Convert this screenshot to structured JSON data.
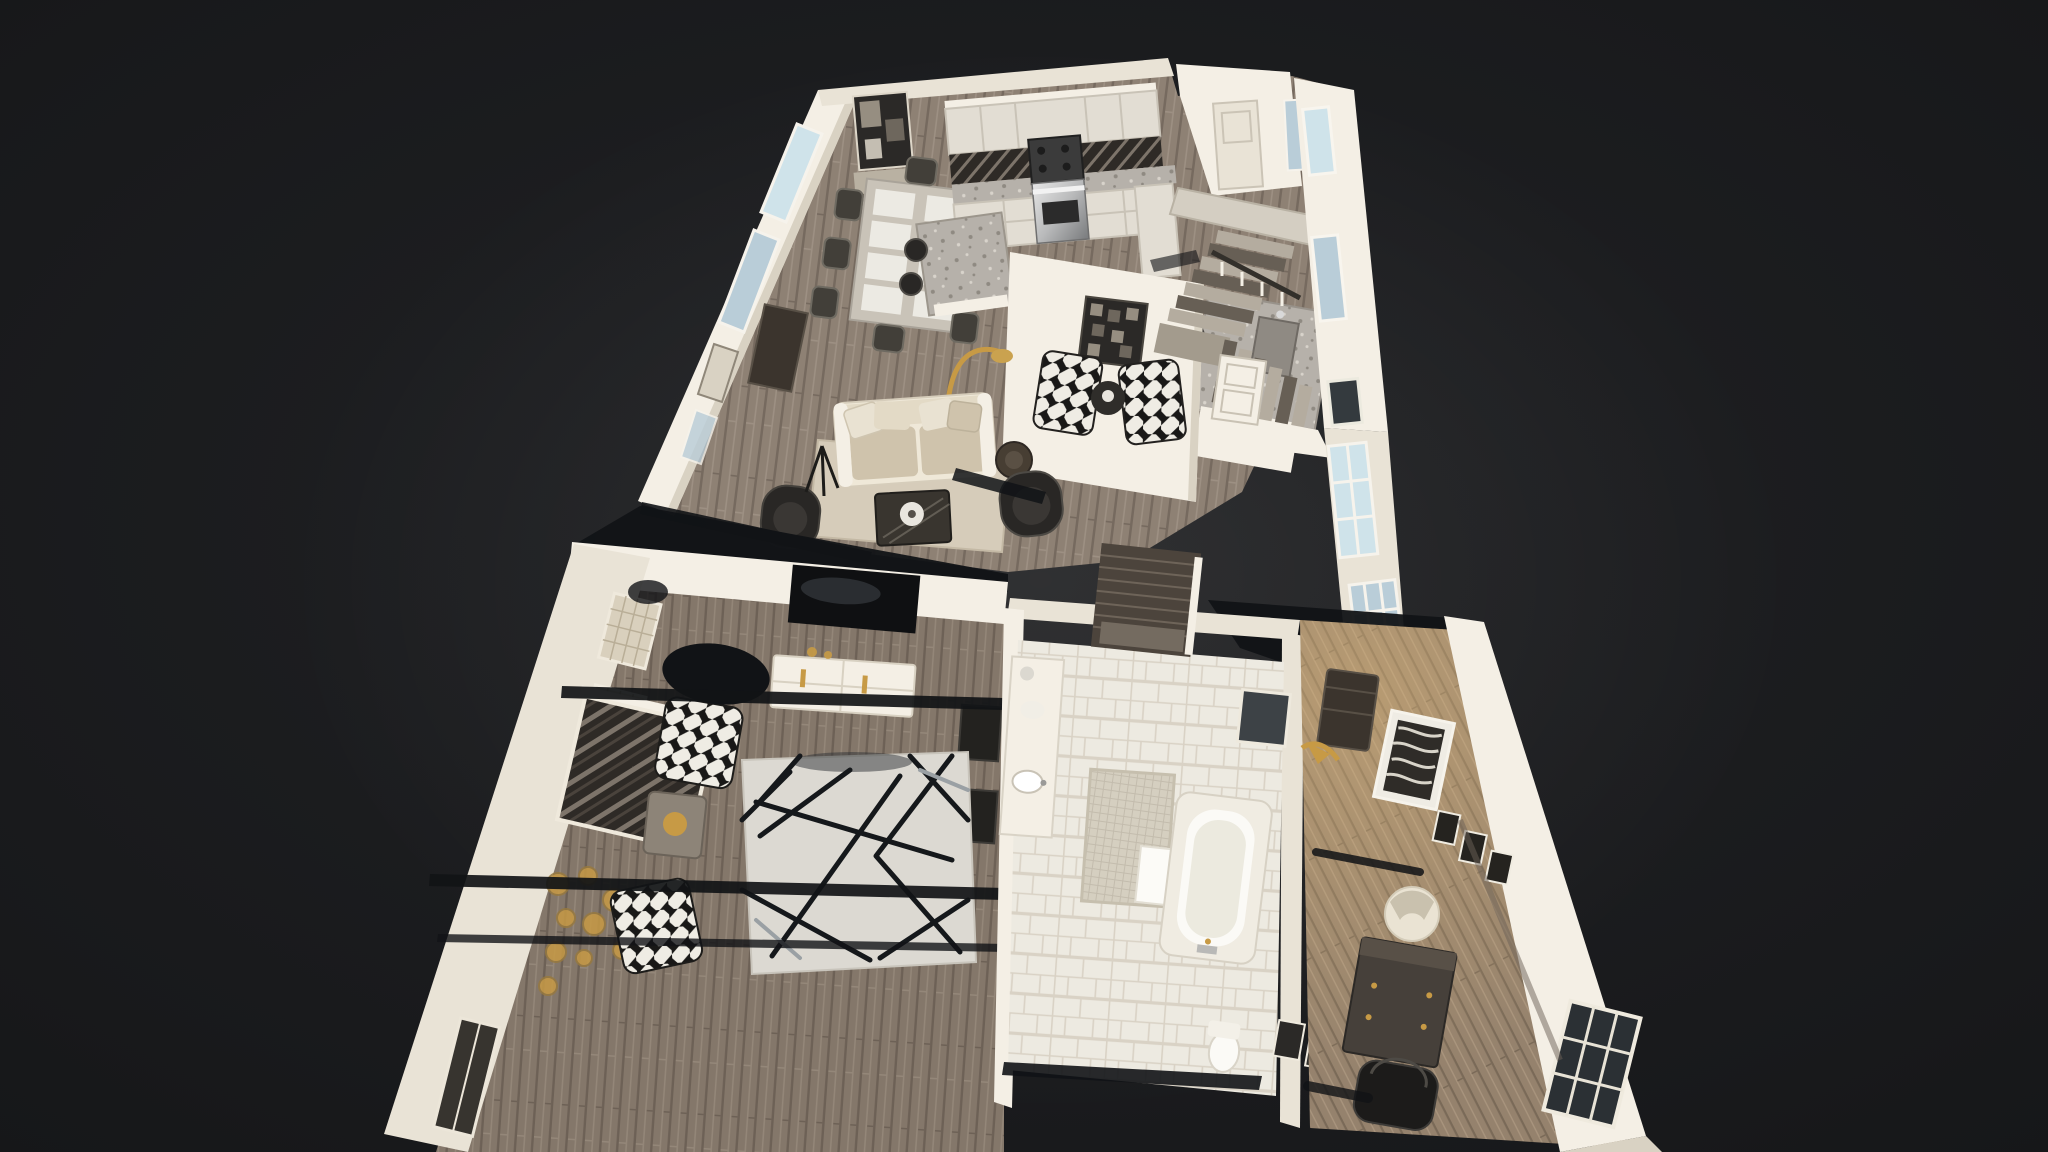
{
  "app": {
    "name": "3D dollhouse tour viewer",
    "view": "Dollhouse view of single-family home interior"
  },
  "scene": {
    "floors": [
      {
        "id": "upper",
        "label": "Rear section — kitchen, dining area, living room, sitting nook and staircase",
        "rooms": [
          "Kitchen",
          "Dining area",
          "Living room",
          "Sitting nook",
          "Staircase hall"
        ]
      },
      {
        "id": "lower",
        "label": "Front section — master bedroom, master bathroom and study",
        "rooms": [
          "Master bedroom",
          "Master bathroom",
          "Study"
        ]
      }
    ],
    "palette": {
      "bg": "#191a1c",
      "glow": "#fff8eb",
      "wallBright": "#f4efe5",
      "wall": "#e9e3d6",
      "wallDim": "#d9d2c3",
      "wallShade": "#b9b1a2",
      "woodUp": "#8e8174",
      "woodUpDark": "#766a5f",
      "woodUpLight": "#9d9083",
      "woodBed": "#84776a",
      "woodBedDark": "#6d6156",
      "woodBedLight": "#948779",
      "woodOfc": "#95826d",
      "woodOfcDark": "#7a6a58",
      "woodOfcLight": "#a8947d",
      "granite": "#b6b1aa",
      "graniteFleckDark": "#8f8a82",
      "graniteFleckLight": "#d8d3cb",
      "cabinet": "#e2ddd3",
      "cabinetLine": "#c9c3b7",
      "backsplash": "#2e2a26",
      "backsplashLight": "#7d746a",
      "steelLight": "#e6e6e6",
      "steelMid": "#b9babb",
      "steelDark": "#787a7c",
      "sofa": "#efe8d8",
      "sofaBack": "#e3dac6",
      "sofaCushion": "#cfc3ac",
      "pillow": "#e9e2d2",
      "leather": "#292725",
      "leatherEdge": "#4d4a45",
      "rugLiving": "#d6ccba",
      "rugBed": "#dcd9d2",
      "rugLineDark": "#15181b",
      "rugLineGray": "#9aa0a4",
      "tile": "#edeae1",
      "grout": "#d9d2c5",
      "mosaic": "#d5cfc0",
      "mosaicGrid": "#c3bcad",
      "shower": "#4c443c",
      "showerBrick": "#6e6459",
      "glass": "#cfe3ea",
      "glassDim": "#b9cdd8",
      "muntin": "#f6f3ec",
      "gold": "#c79a45",
      "artDark": "#2b2927",
      "artBlockLight": "#968e81",
      "artBlockMid": "#6e675d",
      "slash": "#111316",
      "tubOuter": "#f0ece2",
      "tubInner": "#fbfaf6",
      "tubShade": "#eceadf",
      "furnDark": "#3b342d",
      "furnDarker": "#23221f",
      "bwBase": "#efece4",
      "bwTri": "#191817",
      "tableTop": "#c9c3b8",
      "placemat": "#eceae3",
      "chairDark": "#423f39",
      "chairDarkEdge": "#6e6a61"
    }
  }
}
